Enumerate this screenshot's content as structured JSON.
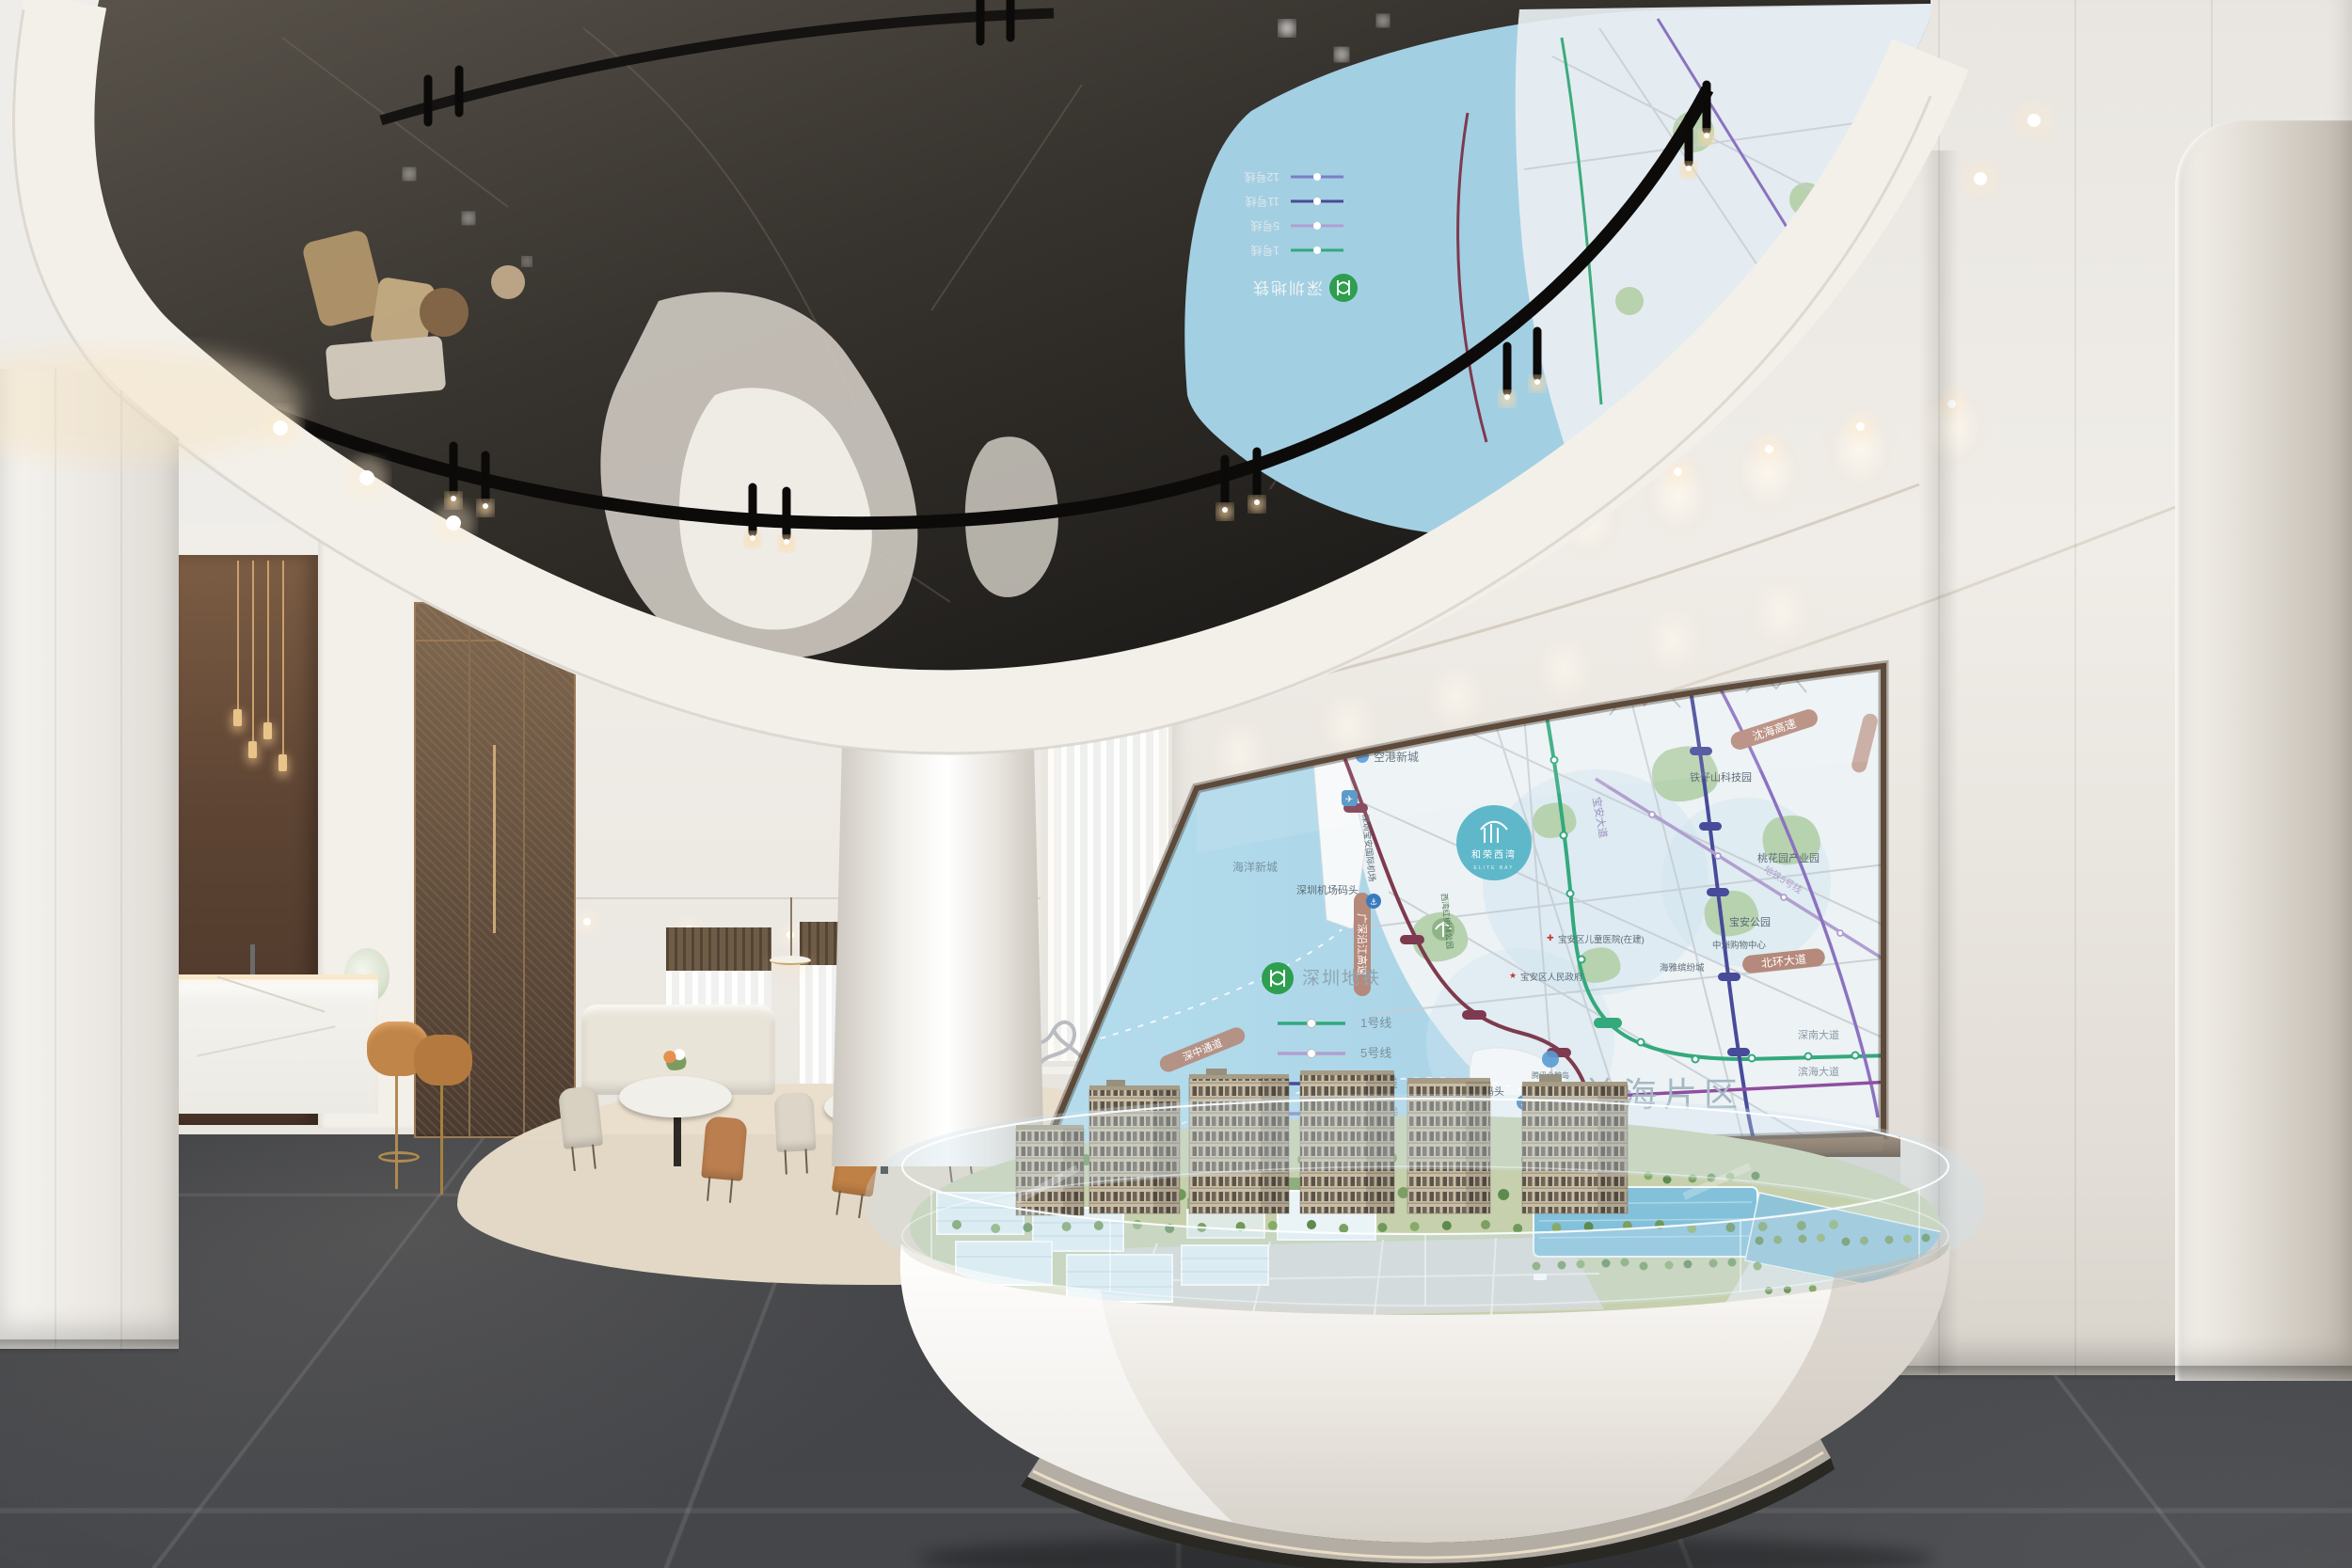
{
  "scene_palette": {
    "mirror_ceiling": "#2b2823",
    "wall_white": "#efece7",
    "floor_tile": "#44454a",
    "accent_wood": "#5d4536",
    "brass": "#b08a4e",
    "screen_frame": "#5d4a3a",
    "sea": "#a9d4e7",
    "land": "#edf2f5",
    "lawn": "#c6d0ad",
    "tower": "#c9bda6",
    "glass": "#d7e9f2"
  },
  "map": {
    "region_label": "前海片区",
    "project": {
      "name": "和荣西湾",
      "subtitle": "ELITE BAY"
    },
    "legend": {
      "title": "深圳地铁",
      "lines": [
        {
          "label": "1号线",
          "color": "#33a97c"
        },
        {
          "label": "5号线",
          "color": "#b19fd0"
        },
        {
          "label": "11号线",
          "color": "#474b99"
        },
        {
          "label": "12号线",
          "color": "#7a7fc4"
        }
      ]
    },
    "roads": {
      "shenhai": "沈海高速",
      "yanjiang": "广深沿江高速",
      "shenzhong": "深中通道",
      "beihuan": "北环大道",
      "shennan": "深南大道",
      "binhai": "滨海大道",
      "baoan_blvd": "宝安大道",
      "metro5_label": "地铁5号线"
    },
    "places": {
      "kongang": "空港新城",
      "haiyang": "海洋新城",
      "airport_wharf": "深圳机场码头",
      "dachan_wharf": "大铲湾码头",
      "airport": "深圳宝安国际机场",
      "tiezishan": "铁仔山科技园",
      "taohuayuan": "桃花园产业园",
      "baoan_park": "宝安公园",
      "xiwan_park": "西湾红树林公园",
      "gov": "宝安区人民政府",
      "children_hospital": "宝安区儿童医院(在建)",
      "zhongzhou": "中洲购物中心",
      "haiya": "海雅缤纷城",
      "tencent": "腾讯企鹅岛"
    }
  }
}
